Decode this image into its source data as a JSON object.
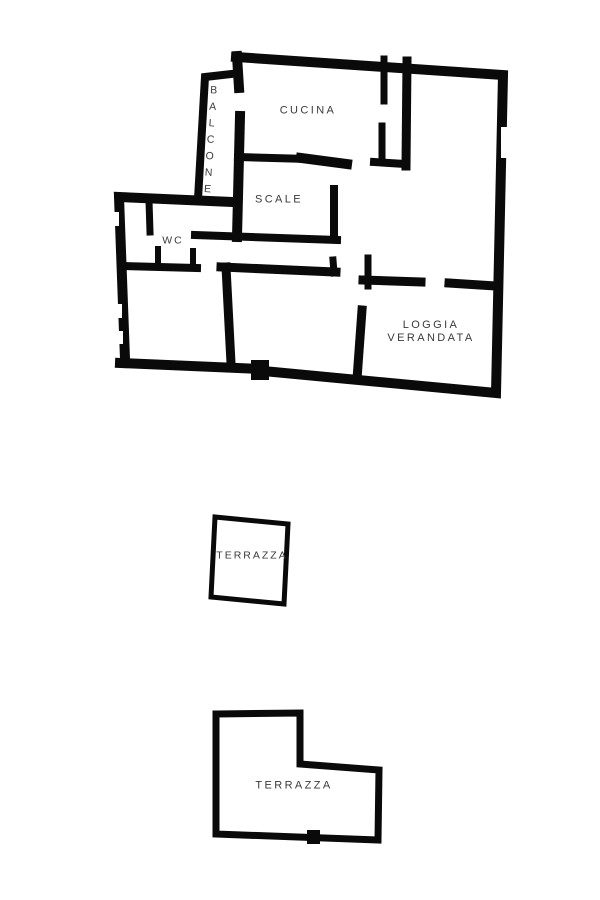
{
  "page": {
    "background_color": "#ffffff",
    "wall_color": "#0a0a0a",
    "label_color": "#3a3a3a"
  },
  "floor_plan": {
    "kind": "apartment-floor-plan",
    "rooms": {
      "balcone": "BALCONE",
      "cucina": "CUCINA",
      "scale": "SCALE",
      "wc": "WC",
      "loggia_line1": "LOGGIA",
      "loggia_line2": "VERANDATA",
      "terrazza_upper": "TERRAZZA",
      "terrazza_lower": "TERRAZZA"
    }
  }
}
